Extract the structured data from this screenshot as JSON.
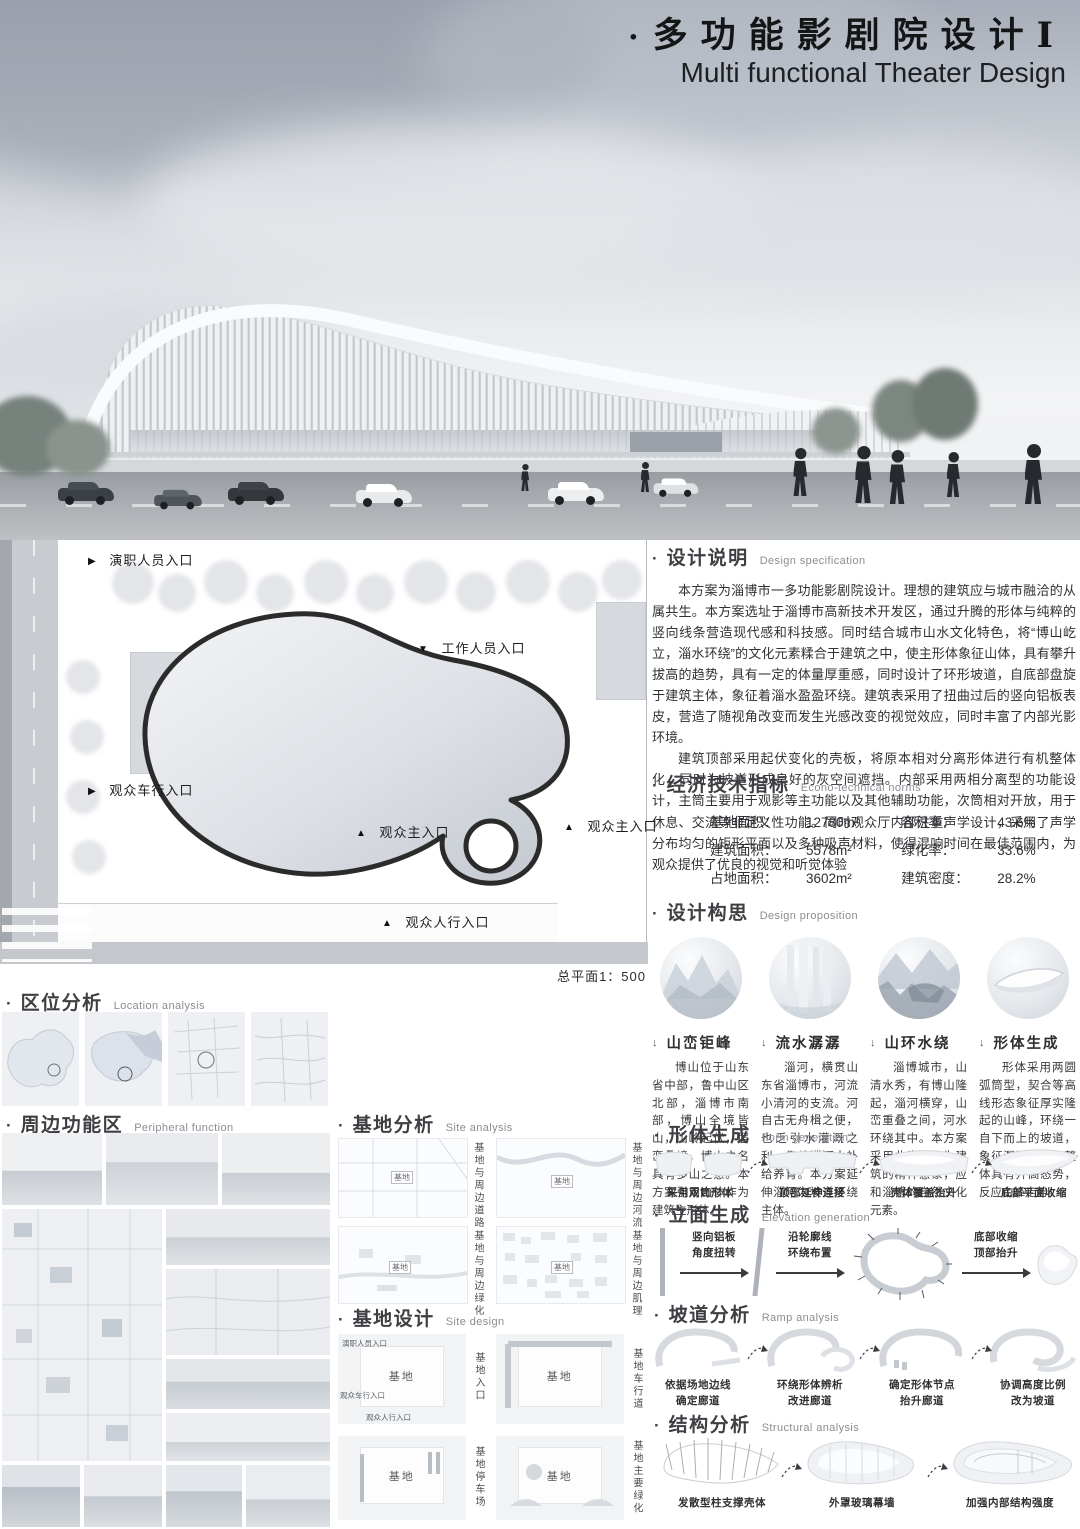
{
  "icons": {
    "bullet": "·",
    "tri_right": "▶",
    "tri_up": "▲",
    "tri_down": "▼",
    "arrow_down": "↓"
  },
  "header": {
    "title_zh": "多功能影剧院设计Ⅰ",
    "title_en": "Multi functional Theater Design"
  },
  "plan": {
    "entry_staff": "演职人员入口",
    "entry_worker": "工作人员入口",
    "entry_vehicle": "观众车行入口",
    "entry_main_l": "观众主入口",
    "entry_main_r": "观众主入口",
    "entry_ped": "观众人行入口",
    "scale": "总平面1：500"
  },
  "spec": {
    "zh": "设计说明",
    "en": "Design specification",
    "p1": "本方案为淄博市一多功能影剧院设计。理想的建筑应与城市融洽的从属共生。本方案选址于淄博市高新技术开发区，通过升腾的形体与纯粹的竖向线条营造现代感和科技感。同时结合城市山水文化特色，将“博山屹立，淄水环绕”的文化元素糅合于建筑之中，使主形体象征山体，具有攀升拔高的趋势，具有一定的体量厚重感，同时设计了环形坡道，自底部盘旋于建筑主体，象征着淄水盈盈环绕。建筑表采用了扭曲过后的竖向铝板表皮，营造了随视角改变而发生光感改变的视觉效应，同时丰富了内部光影环境。",
    "p2": "建筑顶部采用起伏变化的壳板，将原本相对分离形体进行有机整体化，同时为坡道形成良好的灰空间遮挡。内部采用两相分离型的功能设计，主筒主要用于观影等主功能以及其他辅助功能，次筒相对开放，用于休息、交流等非定义性功能。同时观众厅内部注重声学设计，采用了声学分布均匀的矩形平面以及多种吸声材料，使得混响时间在最佳范围内，为观众提供了优良的视觉和听觉体验"
  },
  "econ": {
    "zh": "经济技术指标",
    "en": "Econo-technical norms",
    "left": [
      {
        "k": "基地面积：",
        "v": "12780m²"
      },
      {
        "k": "建筑面积：",
        "v": "5578m²"
      },
      {
        "k": "占地面积：",
        "v": "3602m²"
      }
    ],
    "right": [
      {
        "k": "容积率：",
        "v": "43.6%"
      },
      {
        "k": "绿化率：",
        "v": "33.6%"
      },
      {
        "k": "建筑密度：",
        "v": "28.2%"
      }
    ]
  },
  "prop": {
    "zh": "设计构思",
    "en": "Design proposition",
    "items": [
      {
        "cap": "山峦钜峰",
        "txt": "博山位于山东省中部，鲁中山区北部，淄博市南部，博山全境皆山，山岭起伏，层峦叠嶂，博山之名具有多山之意。本方案引用山体作为建筑主形体。"
      },
      {
        "cap": "流水潺潺",
        "txt": "淄河，横贯山东省淄博市，河流小清河的支流。河自古无舟楫之便，也乏引水灌溉之利，仰赖淄河水补给养育。本方案延伸淄河为坡道环绕主体。"
      },
      {
        "cap": "山环水绕",
        "txt": "淄博城市，山清水秀，有博山隆起，淄河横穿，山峦重叠之间，河水环绕其中。本方案采用此意境作为建筑的精神意象，应和淄博的自然文化元素。"
      },
      {
        "cap": "形体生成",
        "txt": "形体采用两圆弧筒型，契合等高线形态象征厚实隆起的山峰，环绕一自下而上的坡道，象征潺潺淄河。整体具有升高态势，反应山峰走势。"
      }
    ]
  },
  "loc": {
    "zh": "区位分析",
    "en": "Location analysis"
  },
  "peri": {
    "zh": "周边功能区",
    "en": "Peripheral function"
  },
  "sa": {
    "zh": "基地分析",
    "en": "Site analysis",
    "tag": "基地",
    "caps": [
      "基地与周边道路",
      "基地与周边河流",
      "基地与周边绿化",
      "基地与周边肌理"
    ]
  },
  "sd": {
    "zh": "基地设计",
    "en": "Site design",
    "tag": "基地",
    "caps": [
      "基地入口",
      "基地车行道",
      "基地停车场",
      "基地主要绿化"
    ],
    "entries": [
      "演职人员入口",
      "观众车行入口",
      "观众人行入口"
    ]
  },
  "form": {
    "zh": "形体生成",
    "en": "Form generation",
    "steps": [
      "采用双筒形体",
      "顶部延伸连接",
      "壳体覆盖抬升",
      "底部平面收缩"
    ]
  },
  "elev": {
    "zh": "立面生成",
    "en": "Elevation generation",
    "steps": [
      "竖向铝板\n角度扭转",
      "沿轮廓线\n环绕布置",
      "底部收缩\n顶部抬升"
    ]
  },
  "ramp": {
    "zh": "坡道分析",
    "en": "Ramp analysis",
    "steps": [
      "依据场地边线\n确定廊道",
      "环绕形体辨析\n改进廊道",
      "确定形体节点\n抬升廊道",
      "协调高度比例\n改为坡道"
    ]
  },
  "struct": {
    "zh": "结构分析",
    "en": "Structural analysis",
    "steps": [
      "发散型柱支撑壳体",
      "外罩玻璃幕墙",
      "加强内部结构强度"
    ]
  }
}
